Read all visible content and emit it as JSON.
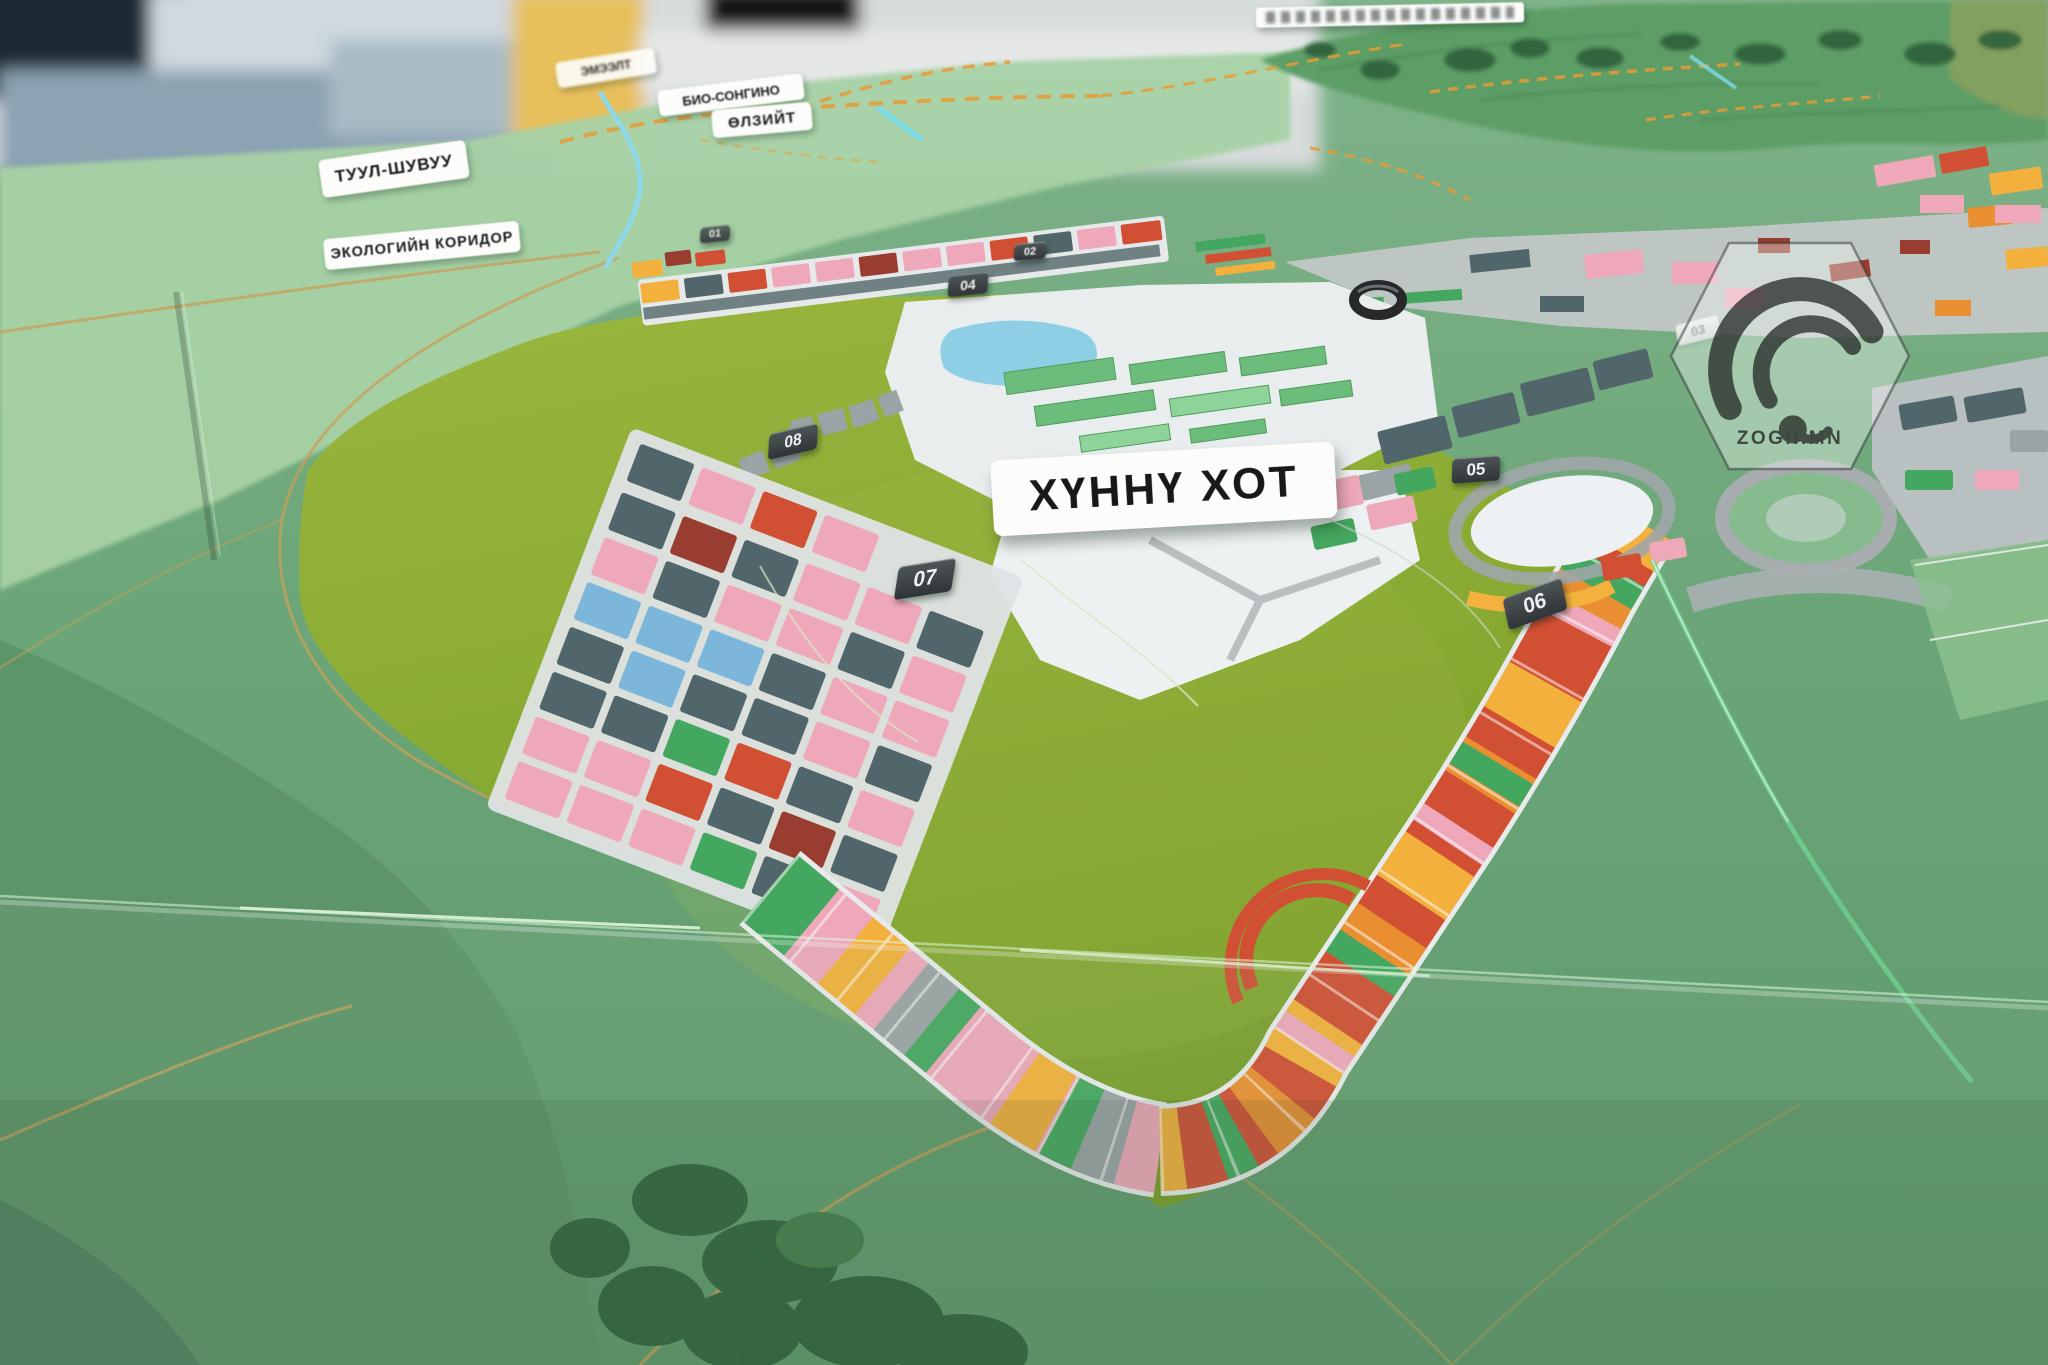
{
  "photo": {
    "signs": {
      "emeelt": "ЭМЭЭЛТ",
      "bio_songino": "БИО-СОНГИНО",
      "ulziit": "ӨЛЗИЙТ",
      "tuul_shuvuu": "ТУУЛ-ШУВУУ",
      "eco_corridor": "ЭКОЛОГИЙН КОРИДОР",
      "khunnu_city": "ХҮННҮ ХОТ"
    },
    "badges": {
      "b01": "01",
      "b02": "02",
      "b03": "03",
      "b04": "04",
      "b05": "05",
      "b06": "06",
      "b07": "07",
      "b08": "08"
    },
    "watermark": {
      "text": "ZOGII.MN"
    },
    "colors": {
      "felt_green": "#8aab33",
      "terrain_green": "#6ca678",
      "block_pink": "#efa8ba",
      "block_slate": "#50666a",
      "block_blue": "#7cb6da",
      "block_green": "#44a75f",
      "block_red": "#d14f33",
      "block_yellow": "#f3b03c",
      "road_orange": "#e89b37",
      "river_cyan": "#8fd8ea",
      "sign_background": "#fcfdfb",
      "badge_background": "#3a4143"
    }
  }
}
